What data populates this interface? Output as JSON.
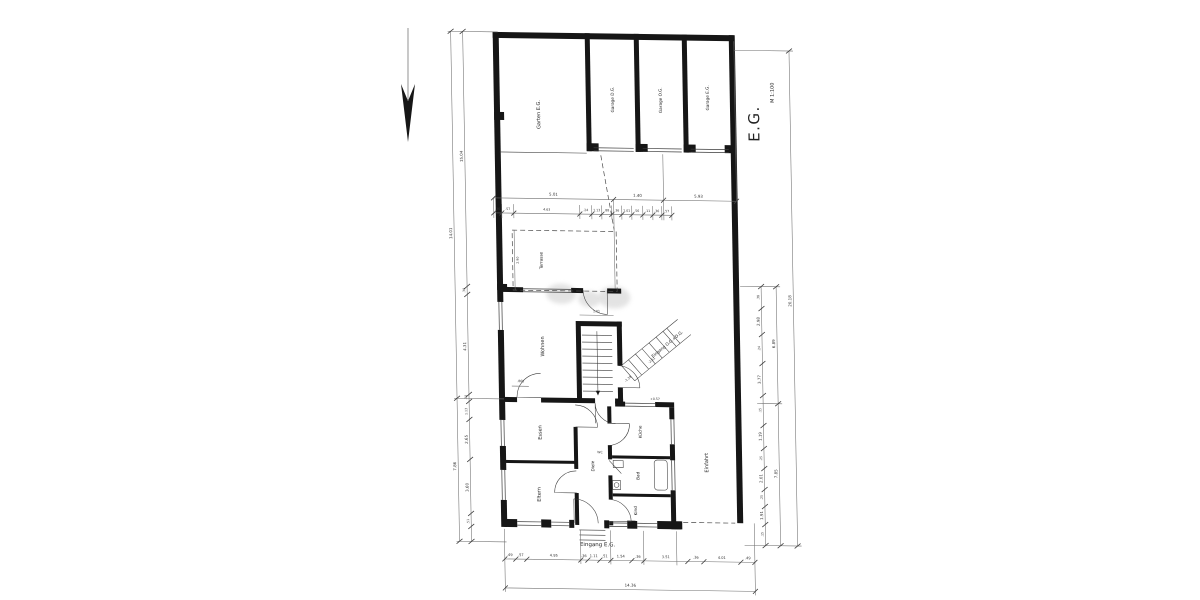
{
  "title": {
    "floor": "E.G.",
    "scale": "M 1:100"
  },
  "rooms": {
    "garten": "Garten E.G.",
    "garage_left": "Garage D.G.",
    "garage_mid": "Garage O.G.",
    "garage_right": "Garage E.G.",
    "terrasse": "Terrasse",
    "wohnen": "Wohnen",
    "essen": "Essen",
    "eltern": "Eltern",
    "diele": "Diele",
    "kueche": "Küche",
    "bad": "Bad",
    "wc": "WC",
    "kind": "Kind",
    "einfahrt": "Einfahrt"
  },
  "annotations": {
    "eingang_eg": "Eingang E.G.",
    "eingang_ogdg": "Eingang O.G.+D.G.",
    "level_1": "-1.38",
    "level_2": "-2.61",
    "level_3": "+0.57"
  },
  "dimensions": {
    "misc": {
      "terrace_h": "2.90",
      "core_w": "1.01",
      "wohnen_d": ".865"
    },
    "left_outer": [
      "14.01",
      "7.86"
    ],
    "left_inner": [
      "15.04",
      ".38",
      "4.31",
      ".30",
      "1.13",
      "2.65",
      "3.60",
      ".51"
    ],
    "right_chain": [
      ".38",
      "2.98",
      ".24",
      "3.77",
      ".15",
      "1.19",
      ".25",
      "2.01",
      ".25",
      "1.91",
      ".15"
    ],
    "right_mid": [
      "6.89",
      "7.85"
    ],
    "right_total": "20.18",
    "top_main": [
      "5.01",
      "1.40",
      "5.93"
    ],
    "top_chain": [
      ".36",
      ".57",
      "4.63",
      ".24",
      "1.13",
      ".88",
      ".36",
      "1.01",
      ".56",
      ".11",
      ".36",
      ".57"
    ],
    "bottom_chain": [
      ".49",
      ".57",
      "4.95",
      ".36",
      "1.11",
      ".51",
      "1.54",
      ".36",
      "3.51",
      ".36",
      "4.01",
      ".49"
    ],
    "bottom_total": "14.36"
  }
}
